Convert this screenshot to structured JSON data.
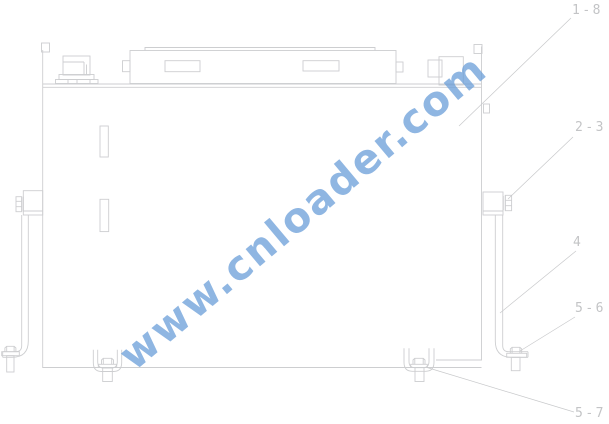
{
  "title": "hydraulic-tank-mounting-technical-drawing",
  "watermark": {
    "text": "www.cnloader.com",
    "color_hex": "#6a9ed8"
  },
  "callouts": [
    {
      "label": "1-8"
    },
    {
      "label": "2-3"
    },
    {
      "label": "4"
    },
    {
      "label": "5-6"
    },
    {
      "label": "5-7"
    }
  ],
  "style": {
    "line_color": "#cdced0",
    "leader_color": "#c8c9cb",
    "label_color": "#c3c4c6",
    "background": "#ffffff"
  }
}
